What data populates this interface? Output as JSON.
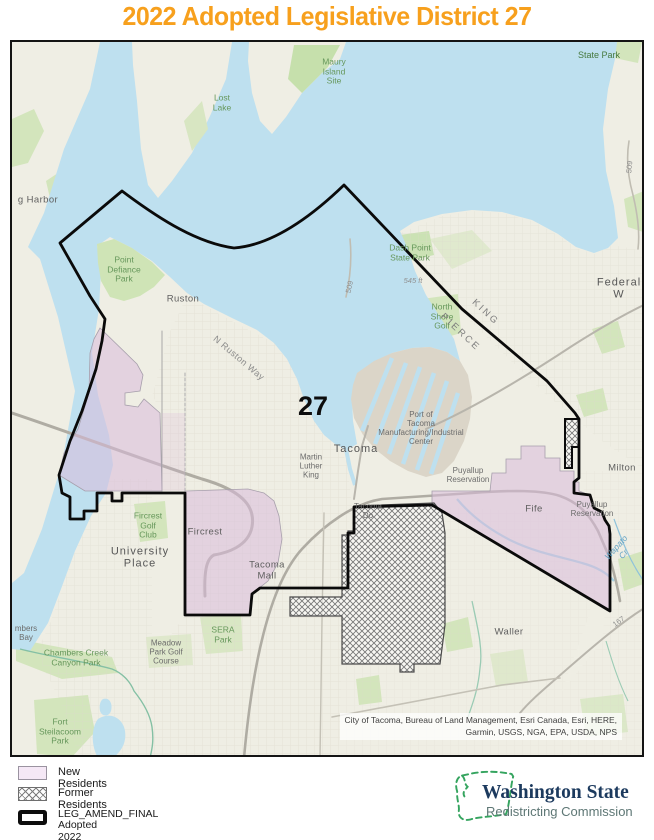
{
  "title": "2022 Adopted Legislative District 27",
  "map": {
    "district_number": "27",
    "labels": [
      {
        "id": "state-park",
        "text": "State Park",
        "cls": "park-dark",
        "x": 597,
        "y": 53
      },
      {
        "id": "lost-lake",
        "text": "Lost\nLake",
        "cls": "park",
        "x": 220,
        "y": 101
      },
      {
        "id": "maury-island-site",
        "text": "Maury\nIsland\nSite",
        "cls": "park",
        "x": 332,
        "y": 70
      },
      {
        "id": "gig-harbor",
        "text": "g Harbor",
        "cls": "city",
        "x": 36,
        "y": 199
      },
      {
        "id": "point-defiance-park",
        "text": "Point\nDefiance\nPark",
        "cls": "park",
        "x": 122,
        "y": 268
      },
      {
        "id": "ruston",
        "text": "Ruston",
        "cls": "city",
        "x": 181,
        "y": 298
      },
      {
        "id": "n-ruston-way",
        "text": "N Ruston Way",
        "cls": "road-lg",
        "x": 237,
        "y": 356,
        "rot": 40
      },
      {
        "id": "dash-point-state-park",
        "text": "Dash Point\nState Park",
        "cls": "park",
        "x": 408,
        "y": 251
      },
      {
        "id": "elev-545",
        "text": "545 ft",
        "cls": "elev",
        "x": 411,
        "y": 279
      },
      {
        "id": "north-shore-golf",
        "text": "North\nShore\nGolf",
        "cls": "park",
        "x": 440,
        "y": 315
      },
      {
        "id": "county-king",
        "text": "KING",
        "cls": "county",
        "x": 483,
        "y": 311,
        "rot": 43
      },
      {
        "id": "county-pierce",
        "text": "PIERCE",
        "cls": "county",
        "x": 458,
        "y": 331,
        "rot": 43
      },
      {
        "id": "federal-way",
        "text": "Federal W",
        "cls": "city-lg",
        "x": 617,
        "y": 287
      },
      {
        "id": "route-509-a",
        "text": "509",
        "cls": "road",
        "x": 348,
        "y": 285,
        "rot": -78
      },
      {
        "id": "route-509-b",
        "text": "509",
        "cls": "road",
        "x": 628,
        "y": 165,
        "rot": -85
      },
      {
        "id": "district-27",
        "text": "27",
        "cls": "district",
        "x": 311,
        "y": 404
      },
      {
        "id": "tacoma",
        "text": "Tacoma",
        "cls": "city-lg",
        "x": 354,
        "y": 447
      },
      {
        "id": "port-of-tacoma",
        "text": "Port of\nTacoma\nManufacturing/Industrial\nCenter",
        "cls": "city-sm",
        "x": 419,
        "y": 427
      },
      {
        "id": "martin-luther-king",
        "text": "Martin\nLuther\nKing",
        "cls": "city-sm",
        "x": 309,
        "y": 465
      },
      {
        "id": "puyallup-reservation-1",
        "text": "Puyallup\nReservation",
        "cls": "city-sm",
        "x": 466,
        "y": 474
      },
      {
        "id": "tacoma-dome",
        "text": "Tacoma\nDo",
        "cls": "city-sm",
        "x": 366,
        "y": 510
      },
      {
        "id": "fircrest-golf-club",
        "text": "Fircrest\nGolf\nClub",
        "cls": "park",
        "x": 146,
        "y": 524
      },
      {
        "id": "fircrest",
        "text": "Fircrest",
        "cls": "city",
        "x": 203,
        "y": 531
      },
      {
        "id": "university-place",
        "text": "University\nPlace",
        "cls": "city-lg",
        "x": 138,
        "y": 556
      },
      {
        "id": "tacoma-mall",
        "text": "Tacoma\nMall",
        "cls": "city",
        "x": 265,
        "y": 569
      },
      {
        "id": "sera-park",
        "text": "SERA\nPark",
        "cls": "park",
        "x": 221,
        "y": 633
      },
      {
        "id": "meadow-park-golf",
        "text": "Meadow\nPark Golf\nCourse",
        "cls": "city-sm",
        "x": 164,
        "y": 651
      },
      {
        "id": "chambers-creek-canyon-park",
        "text": "Chambers Creek\nCanyon Park",
        "cls": "park",
        "x": 74,
        "y": 656
      },
      {
        "id": "chambers-bay",
        "text": "mbers\nBay",
        "cls": "city-sm",
        "x": 24,
        "y": 632
      },
      {
        "id": "fort-steilacoom-park",
        "text": "Fort\nSteilacoom\nPark",
        "cls": "park",
        "x": 58,
        "y": 730
      },
      {
        "id": "milton",
        "text": "Milton",
        "cls": "city",
        "x": 620,
        "y": 467
      },
      {
        "id": "fife",
        "text": "Fife",
        "cls": "city",
        "x": 532,
        "y": 508
      },
      {
        "id": "puyallup-reservation-2",
        "text": "Puyallup\nReservation",
        "cls": "city-sm",
        "x": 590,
        "y": 508
      },
      {
        "id": "waller",
        "text": "Waller",
        "cls": "city",
        "x": 507,
        "y": 631
      },
      {
        "id": "wapato-creek",
        "text": "Wapato Cr",
        "cls": "water-lbl",
        "x": 618,
        "y": 549,
        "rot": -48
      },
      {
        "id": "route-167",
        "text": "167",
        "cls": "road",
        "x": 617,
        "y": 620,
        "rot": -35
      }
    ],
    "attribution": {
      "line1": "City of Tacoma, Bureau of Land Management, Esri Canada, Esri, HERE,",
      "line2": "Garmin, USGS, NGA, EPA, USDA, NPS"
    },
    "colors": {
      "water": "#BEE0EF",
      "land": "#EFEEE4",
      "park_green": "#D3E5BC",
      "new_residents_fill": "#D9BCDB",
      "district_boundary": "#000000",
      "title_orange": "#F7A01D",
      "logo_green": "#35A45F",
      "logo_navy": "#1C3A5E"
    }
  },
  "legend": {
    "items": [
      {
        "id": "new-residents",
        "label": "New Residents"
      },
      {
        "id": "former-residents",
        "label": "Former Residents"
      },
      {
        "id": "leg-amend-final",
        "label": "LEG_AMEND_FINAL",
        "sublabel": "Adopted 2022"
      }
    ]
  },
  "logo": {
    "line1": "Washington State",
    "line2": "Redistricting Commission"
  }
}
